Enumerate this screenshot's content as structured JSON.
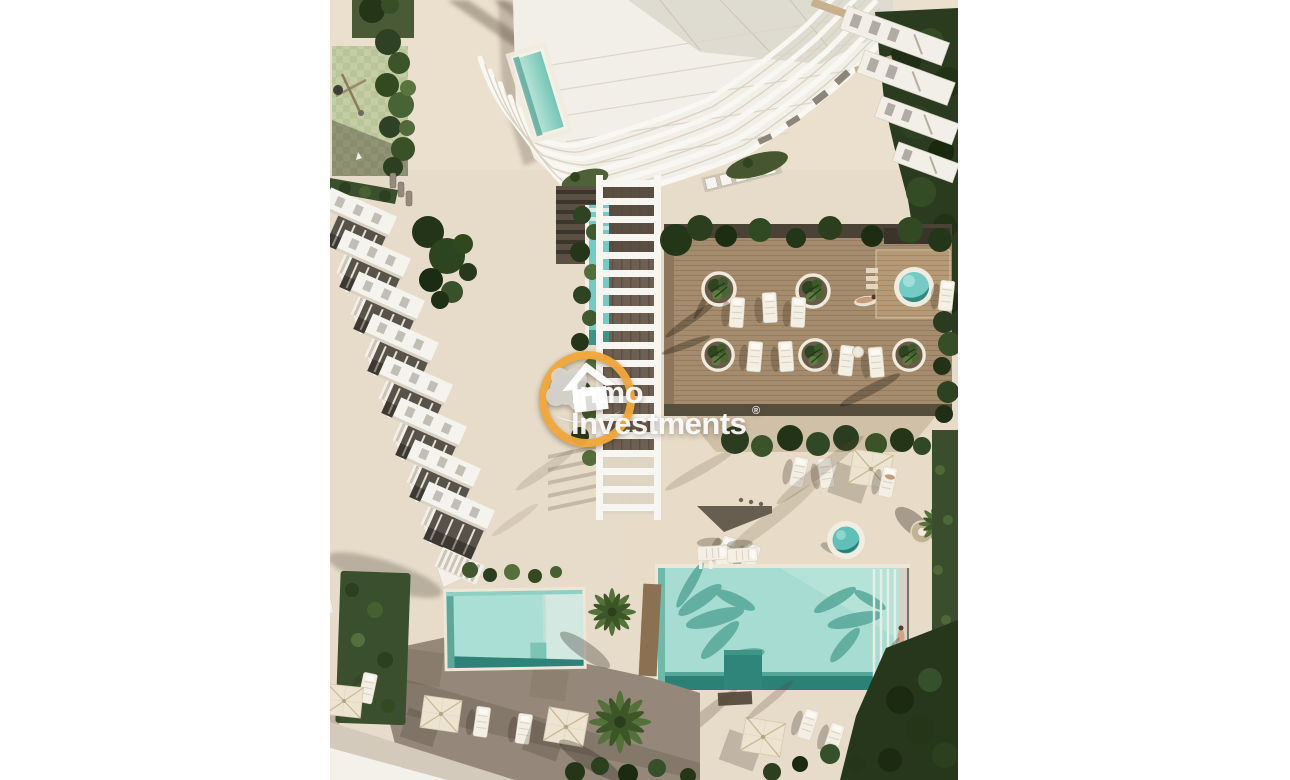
{
  "watermark": {
    "line1": "Inmo",
    "line2": "Investments",
    "registered_symbol": "®",
    "logo_icon": "house-splash-in-yellow-ring-icon"
  },
  "colors": {
    "background": "#ffffff",
    "pavement": "#e7dcca",
    "building_white": "#f2efe8",
    "terrace_recess_brown": "#57524a",
    "wood_deck": "#a58c6e",
    "deck_edge_dark": "#4a4335",
    "pool_water": "#a6dcd1",
    "pool_water_deep": "#2c8176",
    "jacuzzi_water": "#74cbc5",
    "hedge_green": "#3a4f2e",
    "tree_green": "#2a3b1f",
    "grass_green": "#4a5a36",
    "play_area_green": "#c8d1a2",
    "paving_taupe": "#95887a",
    "parasol_cream": "#ece4d1",
    "walkway_white": "#f4f1ea",
    "logo_yellow": "#f2a93b",
    "watermark_text": "#ffffff"
  }
}
